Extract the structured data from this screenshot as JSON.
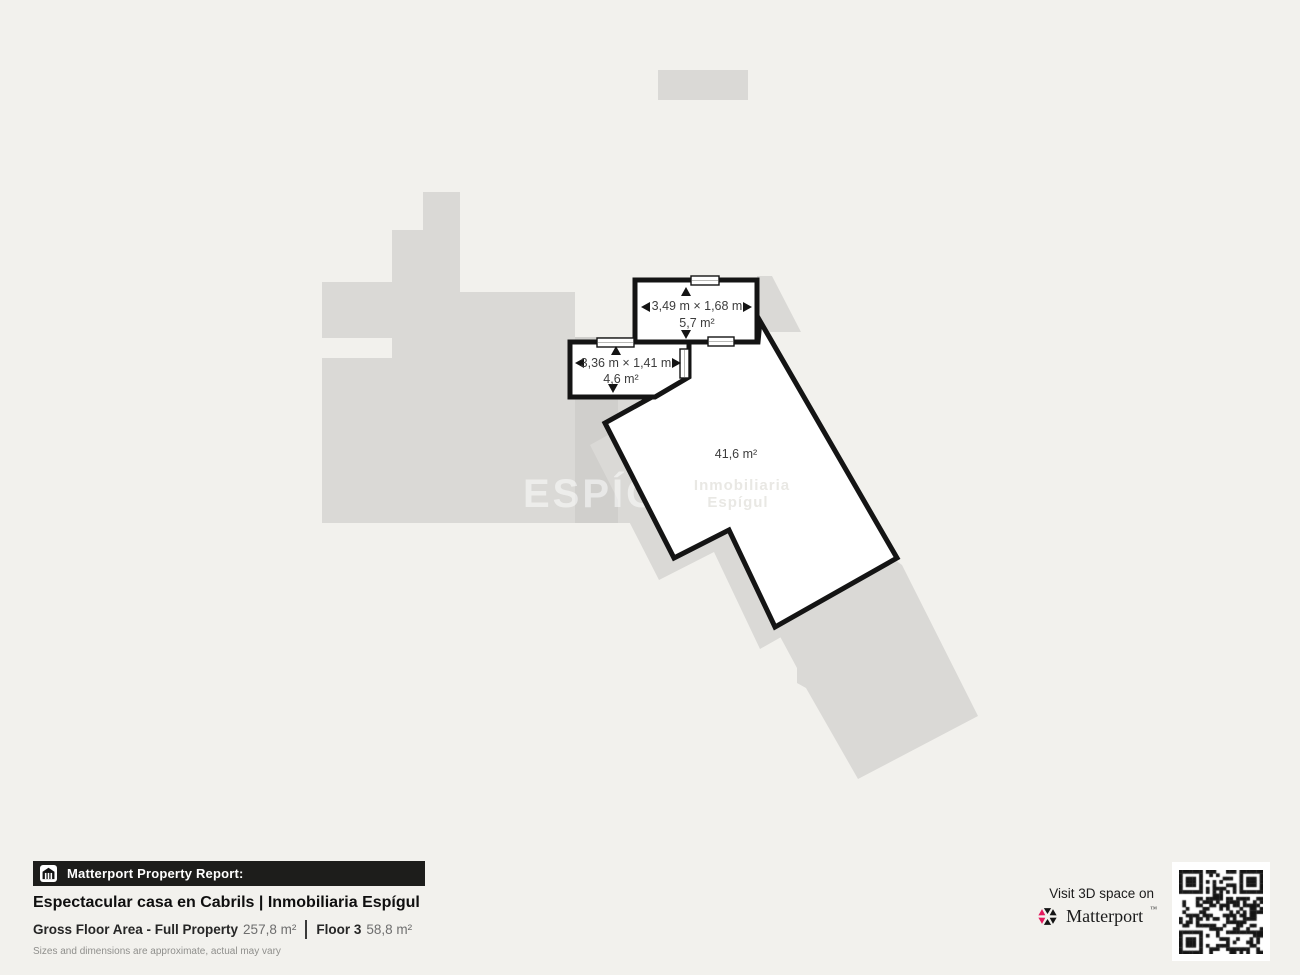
{
  "plan": {
    "rooms": {
      "room_a": {
        "dimensions": "3,49 m × 1,68 m",
        "area": "5,7 m²"
      },
      "room_b": {
        "dimensions": "3,36 m × 1,41 m",
        "area": "4,6 m²"
      },
      "room_main": {
        "area": "41,6 m²"
      }
    },
    "watermark": "ESPÍGUL",
    "watermark_mark": "®",
    "watermark_faint_line1": "Inmobiliaria",
    "watermark_faint_line2": "Espígul"
  },
  "footer": {
    "report_label": "Matterport Property Report:",
    "property_title": "Espectacular casa en Cabrils | Inmobiliaria Espígul",
    "gross_label": "Gross Floor Area - Full Property",
    "gross_value": "257,8 m²",
    "floor_label": "Floor 3",
    "floor_value": "58,8 m²",
    "disclaimer": "Sizes and dimensions are approximate, actual may vary"
  },
  "cta": {
    "visit_label": "Visit 3D space on",
    "brand": "Matterport",
    "brand_mark": "™"
  },
  "colors": {
    "background": "#f2f1ed",
    "underlay_gray": "#dad9d6",
    "underlay_gray_dark": "#d0cfcc",
    "wall_black": "#141414",
    "plan_label_text": "#3d3d3d",
    "footer_bar_bg": "#1d1d1b",
    "title_text": "#0f0f0f",
    "value_gray": "#6e6e6e",
    "disclaimer_gray": "#8f8f8c",
    "matterport_pink": "#e5195e",
    "qr_black": "#151515"
  }
}
